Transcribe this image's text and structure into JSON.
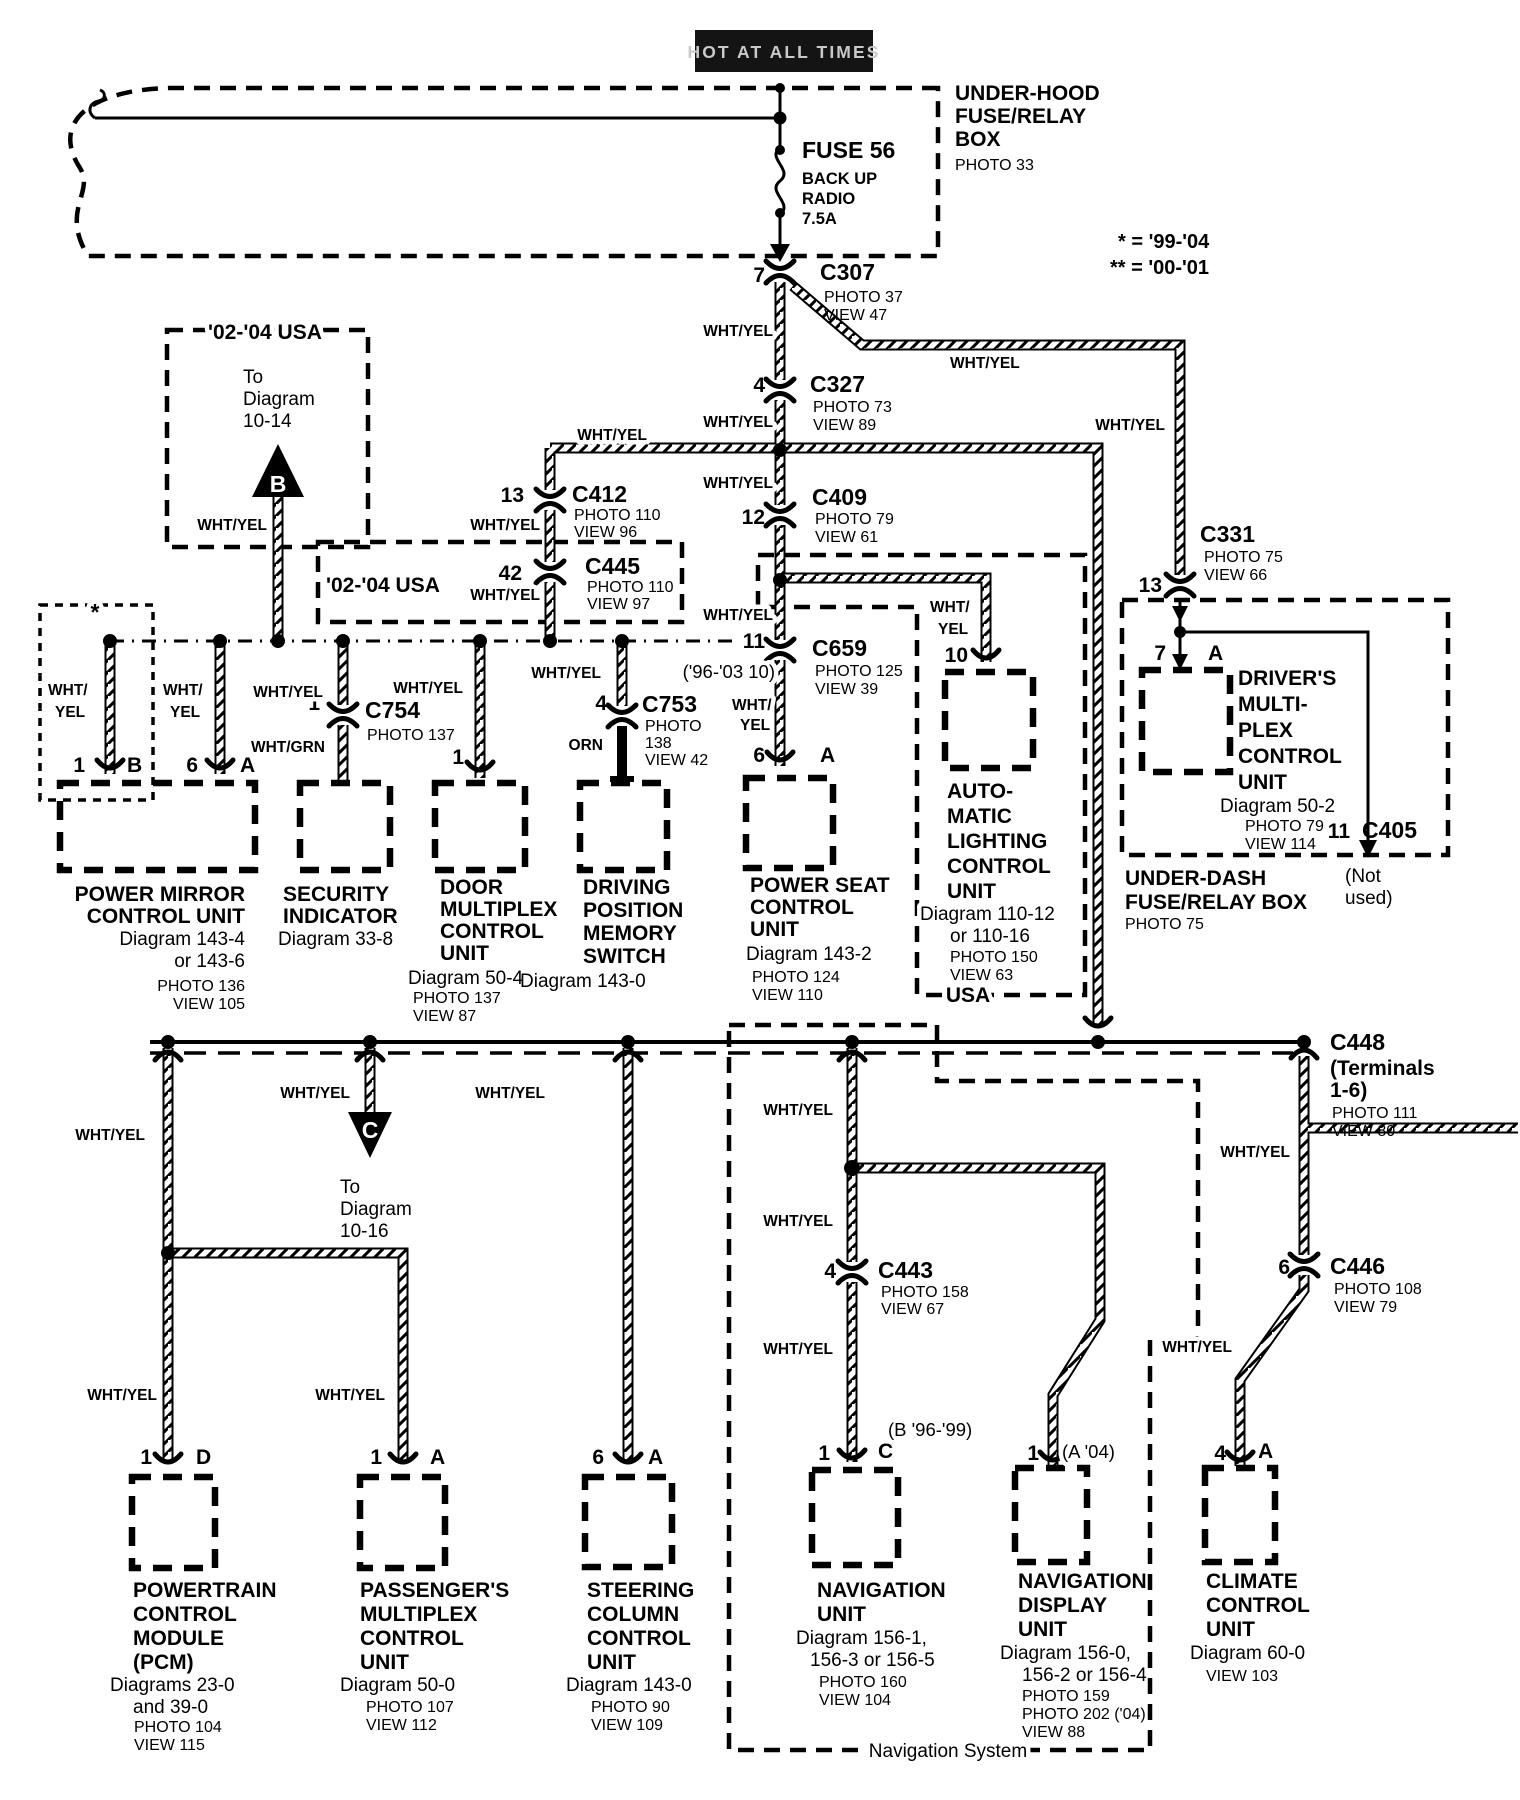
{
  "header": {
    "hot_tag": "HOT AT ALL TIMES",
    "underhood_box": {
      "name_lines": [
        "UNDER-HOOD",
        "FUSE/RELAY",
        "BOX"
      ],
      "photo": "PHOTO 33"
    },
    "fuse": {
      "name": "FUSE 56",
      "desc_lines": [
        "BACK UP",
        "RADIO",
        "7.5A"
      ]
    },
    "notes": [
      "* = '99-'04",
      "** = '00-'01"
    ]
  },
  "wire_colors": {
    "wht_yel": "WHT/YEL",
    "wht_2l": "WHT/",
    "yel_2l": "YEL",
    "wht_grn": "WHT/GRN",
    "orn": "ORN"
  },
  "connectors": {
    "c307": {
      "id": "C307",
      "pin": "7",
      "photo": "PHOTO 37",
      "view": "VIEW 47"
    },
    "c327": {
      "id": "C327",
      "pin": "4",
      "photo": "PHOTO 73",
      "view": "VIEW 89"
    },
    "c412": {
      "id": "C412",
      "pin": "13",
      "photo": "PHOTO 110",
      "view": "VIEW 96"
    },
    "c445": {
      "id": "C445",
      "pin": "42",
      "photo": "PHOTO 110",
      "view": "VIEW 97"
    },
    "c409": {
      "id": "C409",
      "pin": "12",
      "photo": "PHOTO 79",
      "view": "VIEW 61"
    },
    "c659": {
      "id": "C659",
      "pin": "11",
      "note": "('96-'03 10)",
      "photo": "PHOTO 125",
      "view": "VIEW 39"
    },
    "c754": {
      "id": "C754",
      "pin": "1",
      "photo": "PHOTO 137"
    },
    "c753": {
      "id": "C753",
      "pin": "4",
      "lines": [
        "PHOTO",
        "138",
        "VIEW 42"
      ]
    },
    "c331": {
      "id": "C331",
      "pin": "13",
      "photo": "PHOTO 75",
      "view": "VIEW 66"
    },
    "c405": {
      "id": "C405",
      "pin": "11",
      "note_lines": [
        "(Not",
        "used)"
      ]
    },
    "c443": {
      "id": "C443",
      "pin": "4",
      "photo": "PHOTO 158",
      "view": "VIEW 67"
    },
    "c446": {
      "id": "C446",
      "pin": "6",
      "photo": "PHOTO 108",
      "view": "VIEW 79"
    },
    "c448": {
      "id": "C448",
      "terminal_lines": [
        "(Terminals",
        "1-6)"
      ],
      "photo": "PHOTO 111",
      "view": "VIEW 80"
    }
  },
  "markers": {
    "b": {
      "letter": "B",
      "dest_lines": [
        "To",
        "Diagram",
        "10-14"
      ]
    },
    "c": {
      "letter": "C",
      "dest_lines": [
        "To",
        "Diagram",
        "10-16"
      ]
    }
  },
  "regions": {
    "usa_0204_upper": "'02-'04 USA",
    "usa_0204_lower": "'02-'04 USA",
    "usa": "USA",
    "star": "*",
    "navigation_system": "Navigation System"
  },
  "units": {
    "power_mirror": {
      "name_lines": [
        "POWER MIRROR",
        "CONTROL UNIT"
      ],
      "refs": [
        "Diagram 143-4",
        "or 143-6"
      ],
      "photo": "PHOTO 136",
      "view": "VIEW 105",
      "pin1": "1",
      "pin1l": "B",
      "pin2": "6",
      "pin2l": "A"
    },
    "security": {
      "name_lines": [
        "SECURITY",
        "INDICATOR"
      ],
      "ref": "Diagram 33-8"
    },
    "door_mpx": {
      "name_lines": [
        "DOOR",
        "MULTIPLEX",
        "CONTROL",
        "UNIT"
      ],
      "ref": "Diagram 50-4",
      "photo": "PHOTO 137",
      "view": "VIEW 87",
      "pin": "1"
    },
    "driving_pos": {
      "name_lines": [
        "DRIVING",
        "POSITION",
        "MEMORY",
        "SWITCH"
      ],
      "ref": "Diagram 143-0"
    },
    "power_seat": {
      "name_lines": [
        "POWER SEAT",
        "CONTROL",
        "UNIT"
      ],
      "ref": "Diagram 143-2",
      "photo": "PHOTO 124",
      "view": "VIEW 110",
      "pin": "6",
      "pinl": "A"
    },
    "auto_lighting": {
      "name_lines": [
        "AUTO-",
        "MATIC",
        "LIGHTING",
        "CONTROL",
        "UNIT"
      ],
      "refs": [
        "Diagram 110-12",
        "or 110-16"
      ],
      "photo": "PHOTO 150",
      "view": "VIEW 63",
      "pin": "10"
    },
    "drivers_mpx": {
      "name_lines": [
        "DRIVER'S",
        "MULTI-",
        "PLEX",
        "CONTROL",
        "UNIT"
      ],
      "ref": "Diagram 50-2",
      "photo": "PHOTO 79",
      "view": "VIEW 114",
      "pin": "7",
      "pinl": "A"
    },
    "underdash": {
      "name_lines": [
        "UNDER-DASH",
        "FUSE/RELAY BOX"
      ],
      "photo": "PHOTO 75"
    },
    "pcm": {
      "name_lines": [
        "POWERTRAIN",
        "CONTROL",
        "MODULE",
        "(PCM)"
      ],
      "refs": [
        "Diagrams 23-0",
        "and 39-0"
      ],
      "photo": "PHOTO 104",
      "view": "VIEW 115",
      "pin": "1",
      "pinl": "D"
    },
    "passenger_mpx": {
      "name_lines": [
        "PASSENGER'S",
        "MULTIPLEX",
        "CONTROL",
        "UNIT"
      ],
      "ref": "Diagram 50-0",
      "photo": "PHOTO 107",
      "view": "VIEW 112",
      "pin": "1",
      "pinl": "A"
    },
    "steering": {
      "name_lines": [
        "STEERING",
        "COLUMN",
        "CONTROL",
        "UNIT"
      ],
      "ref": "Diagram 143-0",
      "photo": "PHOTO 90",
      "view": "VIEW 109",
      "pin": "6",
      "pinl": "A"
    },
    "nav_unit": {
      "name_lines": [
        "NAVIGATION",
        "UNIT"
      ],
      "refs": [
        "Diagram 156-1,",
        "156-3 or 156-5"
      ],
      "photo": "PHOTO 160",
      "view": "VIEW 104",
      "pin": "1",
      "pinl": "C",
      "note": "(B '96-'99)"
    },
    "nav_display": {
      "name_lines": [
        "NAVIGATION",
        "DISPLAY",
        "UNIT"
      ],
      "refs": [
        "Diagram 156-0,",
        "156-2 or 156-4"
      ],
      "photos": [
        "PHOTO 159",
        "PHOTO 202 ('04)"
      ],
      "view": "VIEW 88",
      "pin": "1",
      "note": "(A '04)"
    },
    "climate": {
      "name_lines": [
        "CLIMATE",
        "CONTROL",
        "UNIT"
      ],
      "ref": "Diagram 60-0",
      "view": "VIEW 103",
      "pin": "4",
      "pinl": "A"
    }
  }
}
